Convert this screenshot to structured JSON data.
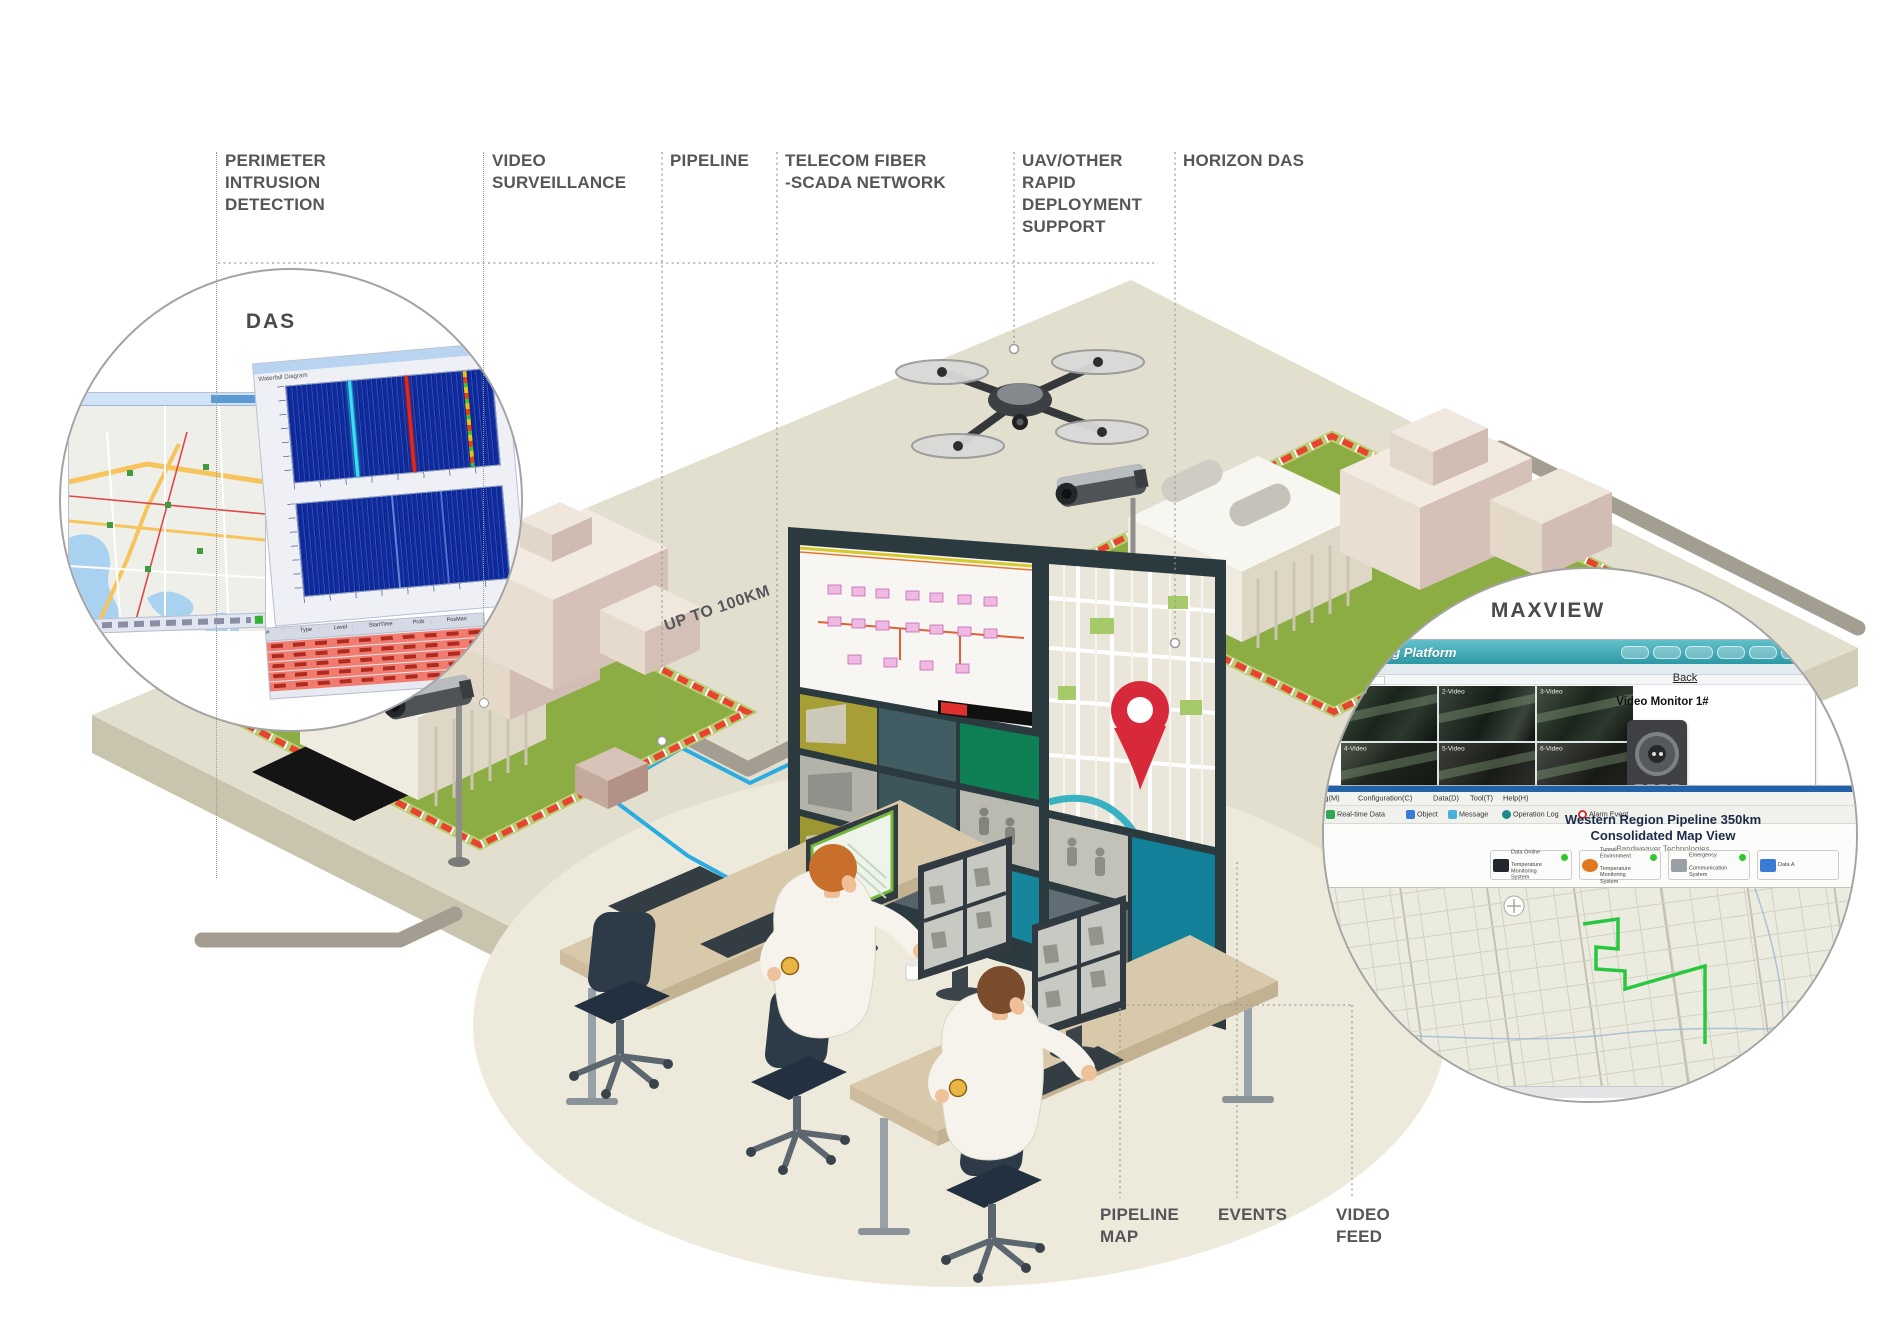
{
  "top_labels": [
    {
      "text": "PERIMETER INTRUSION\nDETECTION"
    },
    {
      "text": "VIDEO\nSURVEILLANCE"
    },
    {
      "text": "PIPELINE"
    },
    {
      "text": "TELECOM FIBER\n-SCADA NETWORK"
    },
    {
      "text": "UAV/OTHER\nRAPID\nDEPLOYMENT\nSUPPORT"
    },
    {
      "text": "HORIZON DAS"
    }
  ],
  "bottom_labels": [
    {
      "text": "PIPELINE\nMAP"
    },
    {
      "text": "EVENTS"
    },
    {
      "text": "VIDEO\nFEED"
    }
  ],
  "scene": {
    "distance_label": "UP TO 100KM"
  },
  "das": {
    "title": "DAS",
    "window_title": "Waterfall Diagram",
    "alarm_table": {
      "columns": [
        "#",
        "Type",
        "Level",
        "StartTime",
        "Prob",
        "PosMax"
      ],
      "row_count": 5
    }
  },
  "maxview": {
    "title": "MAXVIEW",
    "platform_window": {
      "header_title": "Monitoring Platform",
      "back_label": "Back",
      "monitor_label": "Video Monitor 1#",
      "video_labels": [
        "1-Video",
        "2-Video",
        "3-Video",
        "4-Video",
        "5-Video",
        "6-Video"
      ]
    },
    "map_window": {
      "menu_items": [
        "File(F)",
        "Monitoring(M)",
        "Configuration(C)",
        "Data(D)",
        "Tool(T)",
        "Help(H)"
      ],
      "toolbar_items": [
        "User Login",
        "Real-time Data",
        "Object",
        "Message",
        "Operation Log",
        "Alarm Event"
      ],
      "title_line1": "Western Region Pipeline 350km",
      "title_line2": "Consolidated Map View",
      "subtitle": "Bandweaver Technologies",
      "status_cards": [
        {
          "line1": "Data Online",
          "line2": "Temperature Monitoring System"
        },
        {
          "line1": "Tunnel Environment",
          "line2": "Temperature Monitoring System"
        },
        {
          "line1": "Emergency",
          "line2": "Communication System"
        },
        {
          "line1": "Data A",
          "line2": ""
        }
      ]
    }
  },
  "colors": {
    "fence_red": "#e8432e",
    "lawn_green": "#8cad43",
    "fiber_blue": "#2aabe2",
    "pipeline_gray": "#a49d91",
    "platform": "#e3dfcf",
    "teal_header": "#2d99a6",
    "status_green": "#2ec82e",
    "map_pin_red": "#d8293a",
    "label_text": "#55565a"
  }
}
